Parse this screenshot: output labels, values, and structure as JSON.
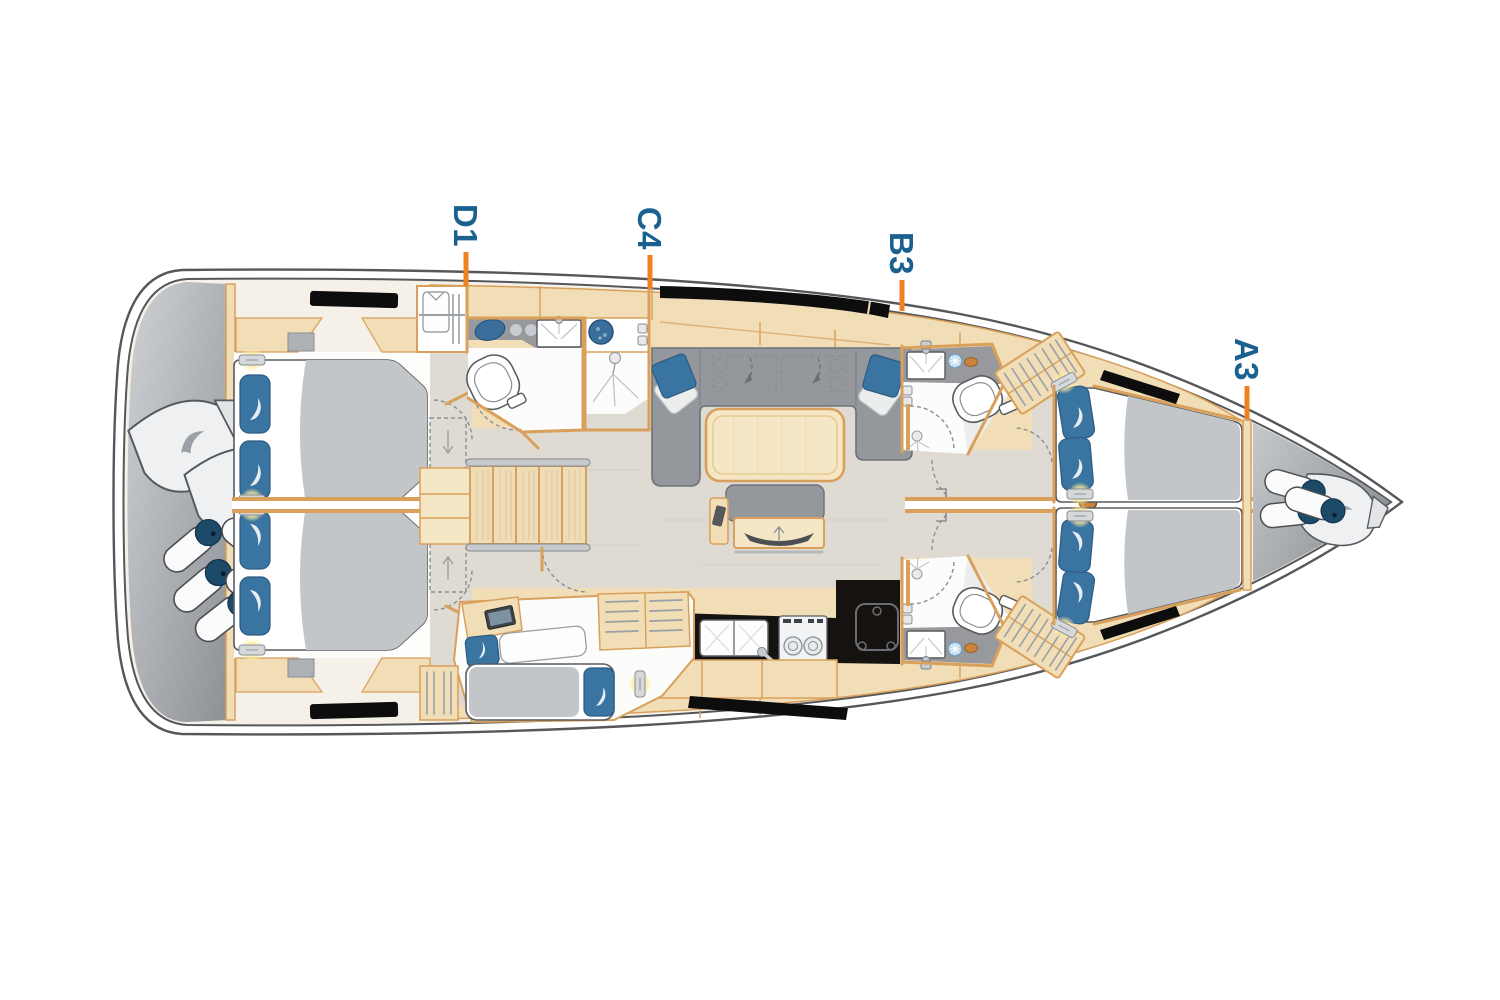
{
  "diagram": {
    "type": "sailing-yacht-interior-deck-plan",
    "orientation": "bow-right",
    "option_labels": [
      {
        "code": "D1"
      },
      {
        "code": "C4"
      },
      {
        "code": "B3"
      },
      {
        "code": "A3"
      }
    ],
    "colors": {
      "label_blue": "#1a6190",
      "leader_orange": "#f08121",
      "hull_outline": "#55575a",
      "deck_cream": "#f6f1e8",
      "wood_beige": "#f1ddb6",
      "wood_border": "#d9a05b",
      "floor_greige": "#dfdbd2",
      "upholstery_gray": "#94989d",
      "duvet_gray": "#c3c6c9",
      "pillow_blue": "#3a74a0",
      "fender_navy": "#1d4a68",
      "window_black": "#0d0d0d",
      "reading_light_glow": "#ffec9e",
      "mast_tan": "#c8833c"
    },
    "icons": [
      "stern-fenders",
      "stern-sail-bags",
      "aft-double-berth",
      "berth-pillow",
      "reading-light",
      "hull-window",
      "companionway-stairs",
      "wardrobe-shirt-hanger",
      "toilet",
      "washbasin",
      "faucet",
      "washing-machine",
      "shower-head",
      "saloon-sofa",
      "sofa-cushion",
      "saloon-table",
      "island-seat",
      "tv-screen",
      "galley-sink",
      "two-burner-stove",
      "fridge",
      "slatted-locker",
      "mast",
      "bow-fenders",
      "bow-sail-bag",
      "single-berth"
    ]
  }
}
